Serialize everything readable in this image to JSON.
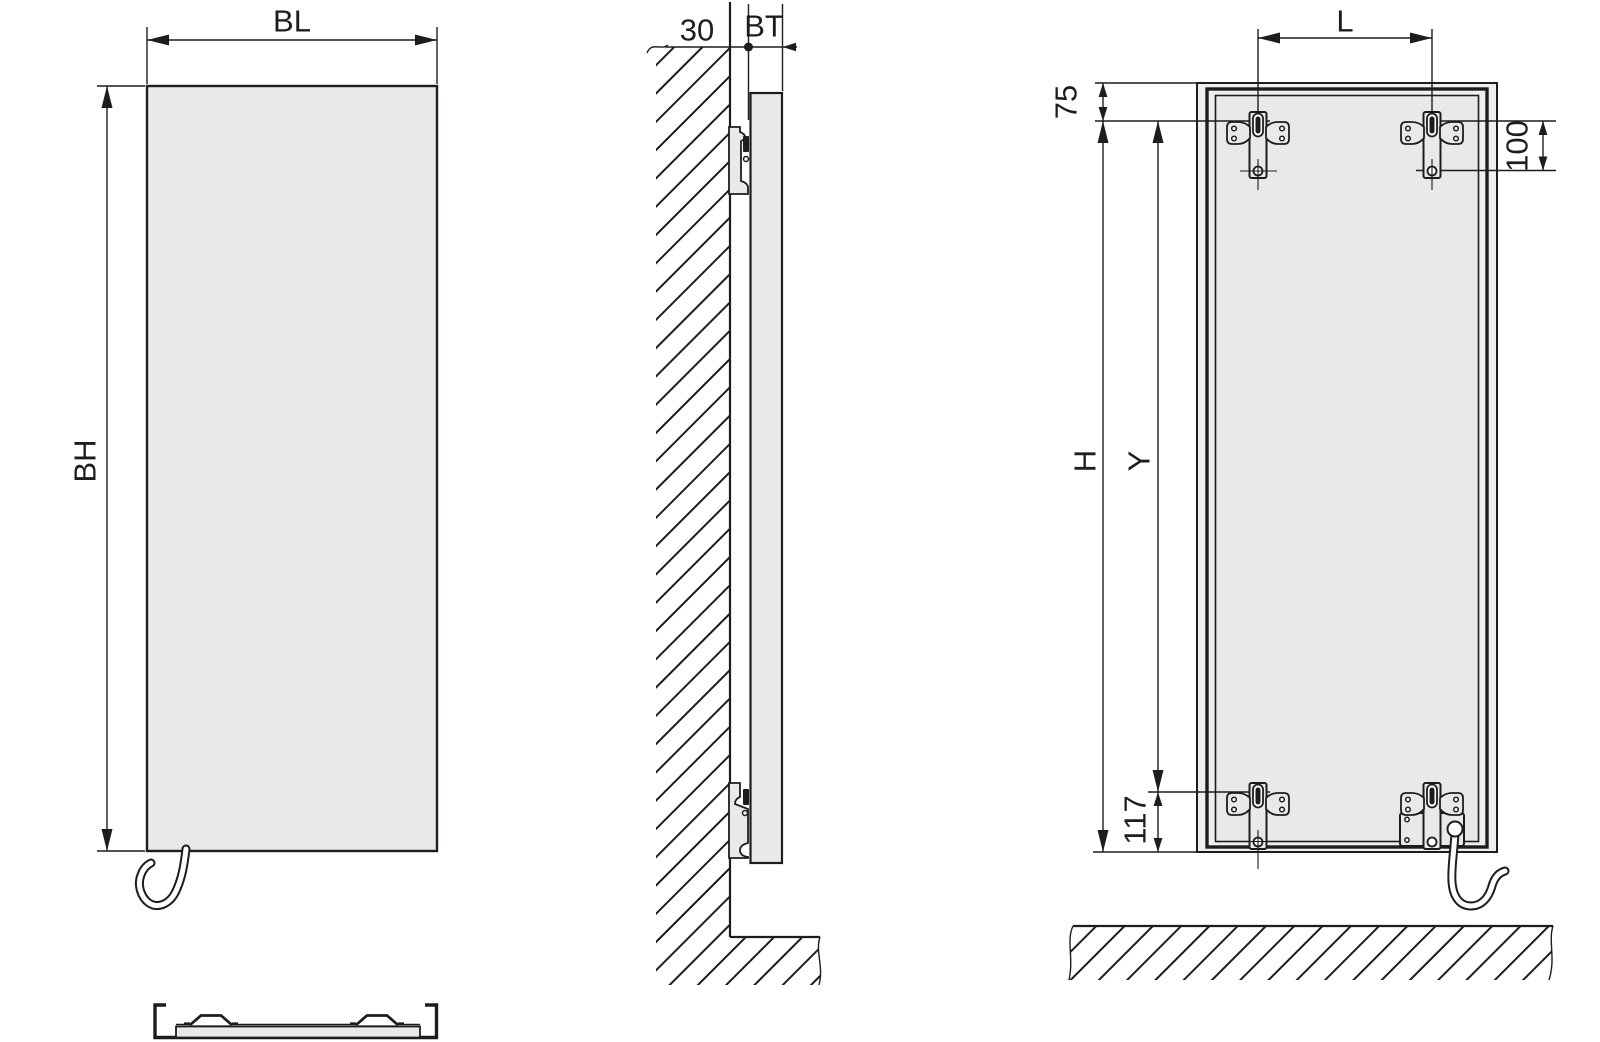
{
  "labels": {
    "front_width": "BL",
    "front_height": "BH",
    "wall_distance": "30",
    "depth": "BT",
    "bracket_spacing": "L",
    "top_edge_to_bracket": "75",
    "bracket_hole_spacing": "100",
    "mounting_height": "H",
    "bracket_vertical_span": "Y",
    "bracket_to_bottom": "117"
  },
  "colors": {
    "line": "#1d1d1d",
    "panel-fill": "#e8e9e9",
    "frame-fill": "#eeefef",
    "paper": "#ffffff"
  }
}
